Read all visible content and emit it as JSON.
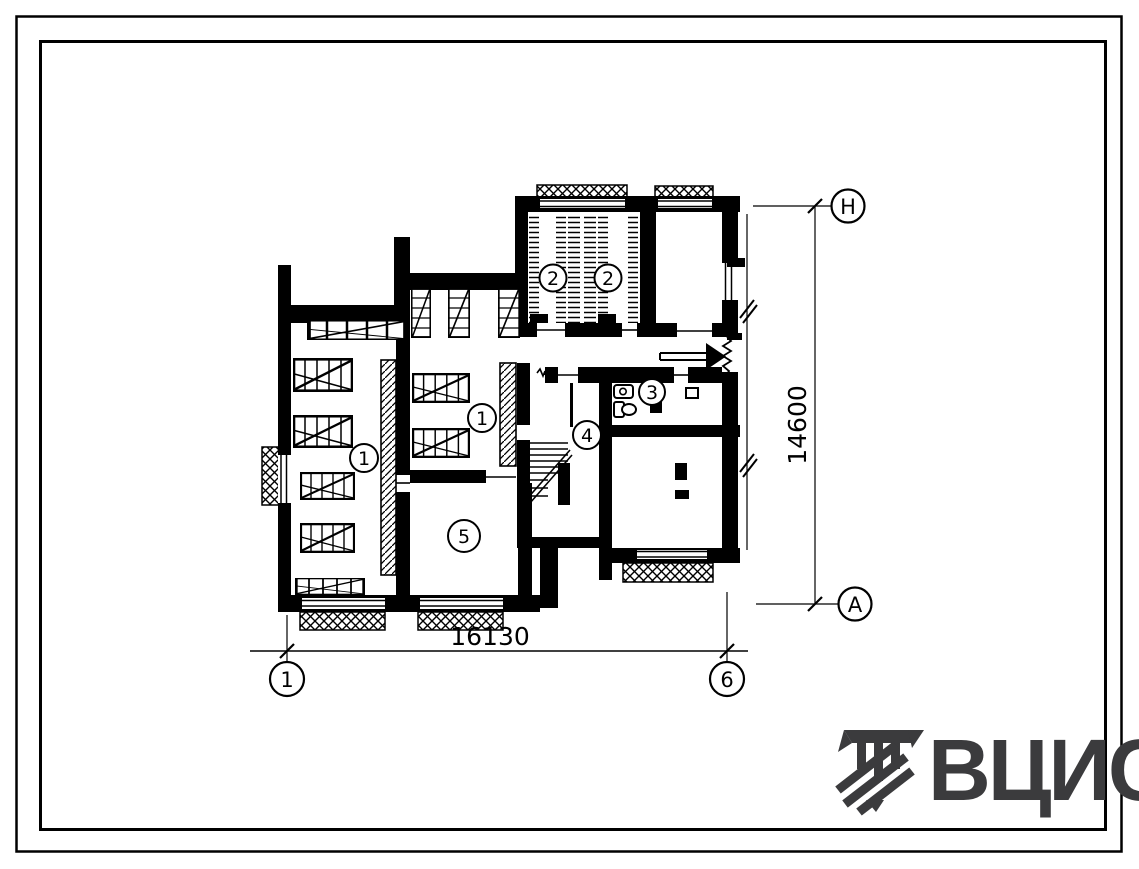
{
  "plan": {
    "room_labels": [
      {
        "id": "room-1-left",
        "text": "1"
      },
      {
        "id": "room-1-right",
        "text": "1"
      },
      {
        "id": "room-2-left",
        "text": "2"
      },
      {
        "id": "room-2-right",
        "text": "2"
      },
      {
        "id": "room-3",
        "text": "3"
      },
      {
        "id": "room-4",
        "text": "4"
      },
      {
        "id": "room-5",
        "text": "5"
      }
    ],
    "axes": {
      "bottom_left": "1",
      "bottom_right": "6",
      "right_top": "Н",
      "right_bottom": "А"
    },
    "dimensions": {
      "horizontal": "16130",
      "vertical": "14600"
    }
  },
  "logo": {
    "text": "ВЦИС"
  },
  "colors": {
    "ink": "#000000",
    "paper": "#ffffff",
    "logo": "#3b3b3d"
  }
}
